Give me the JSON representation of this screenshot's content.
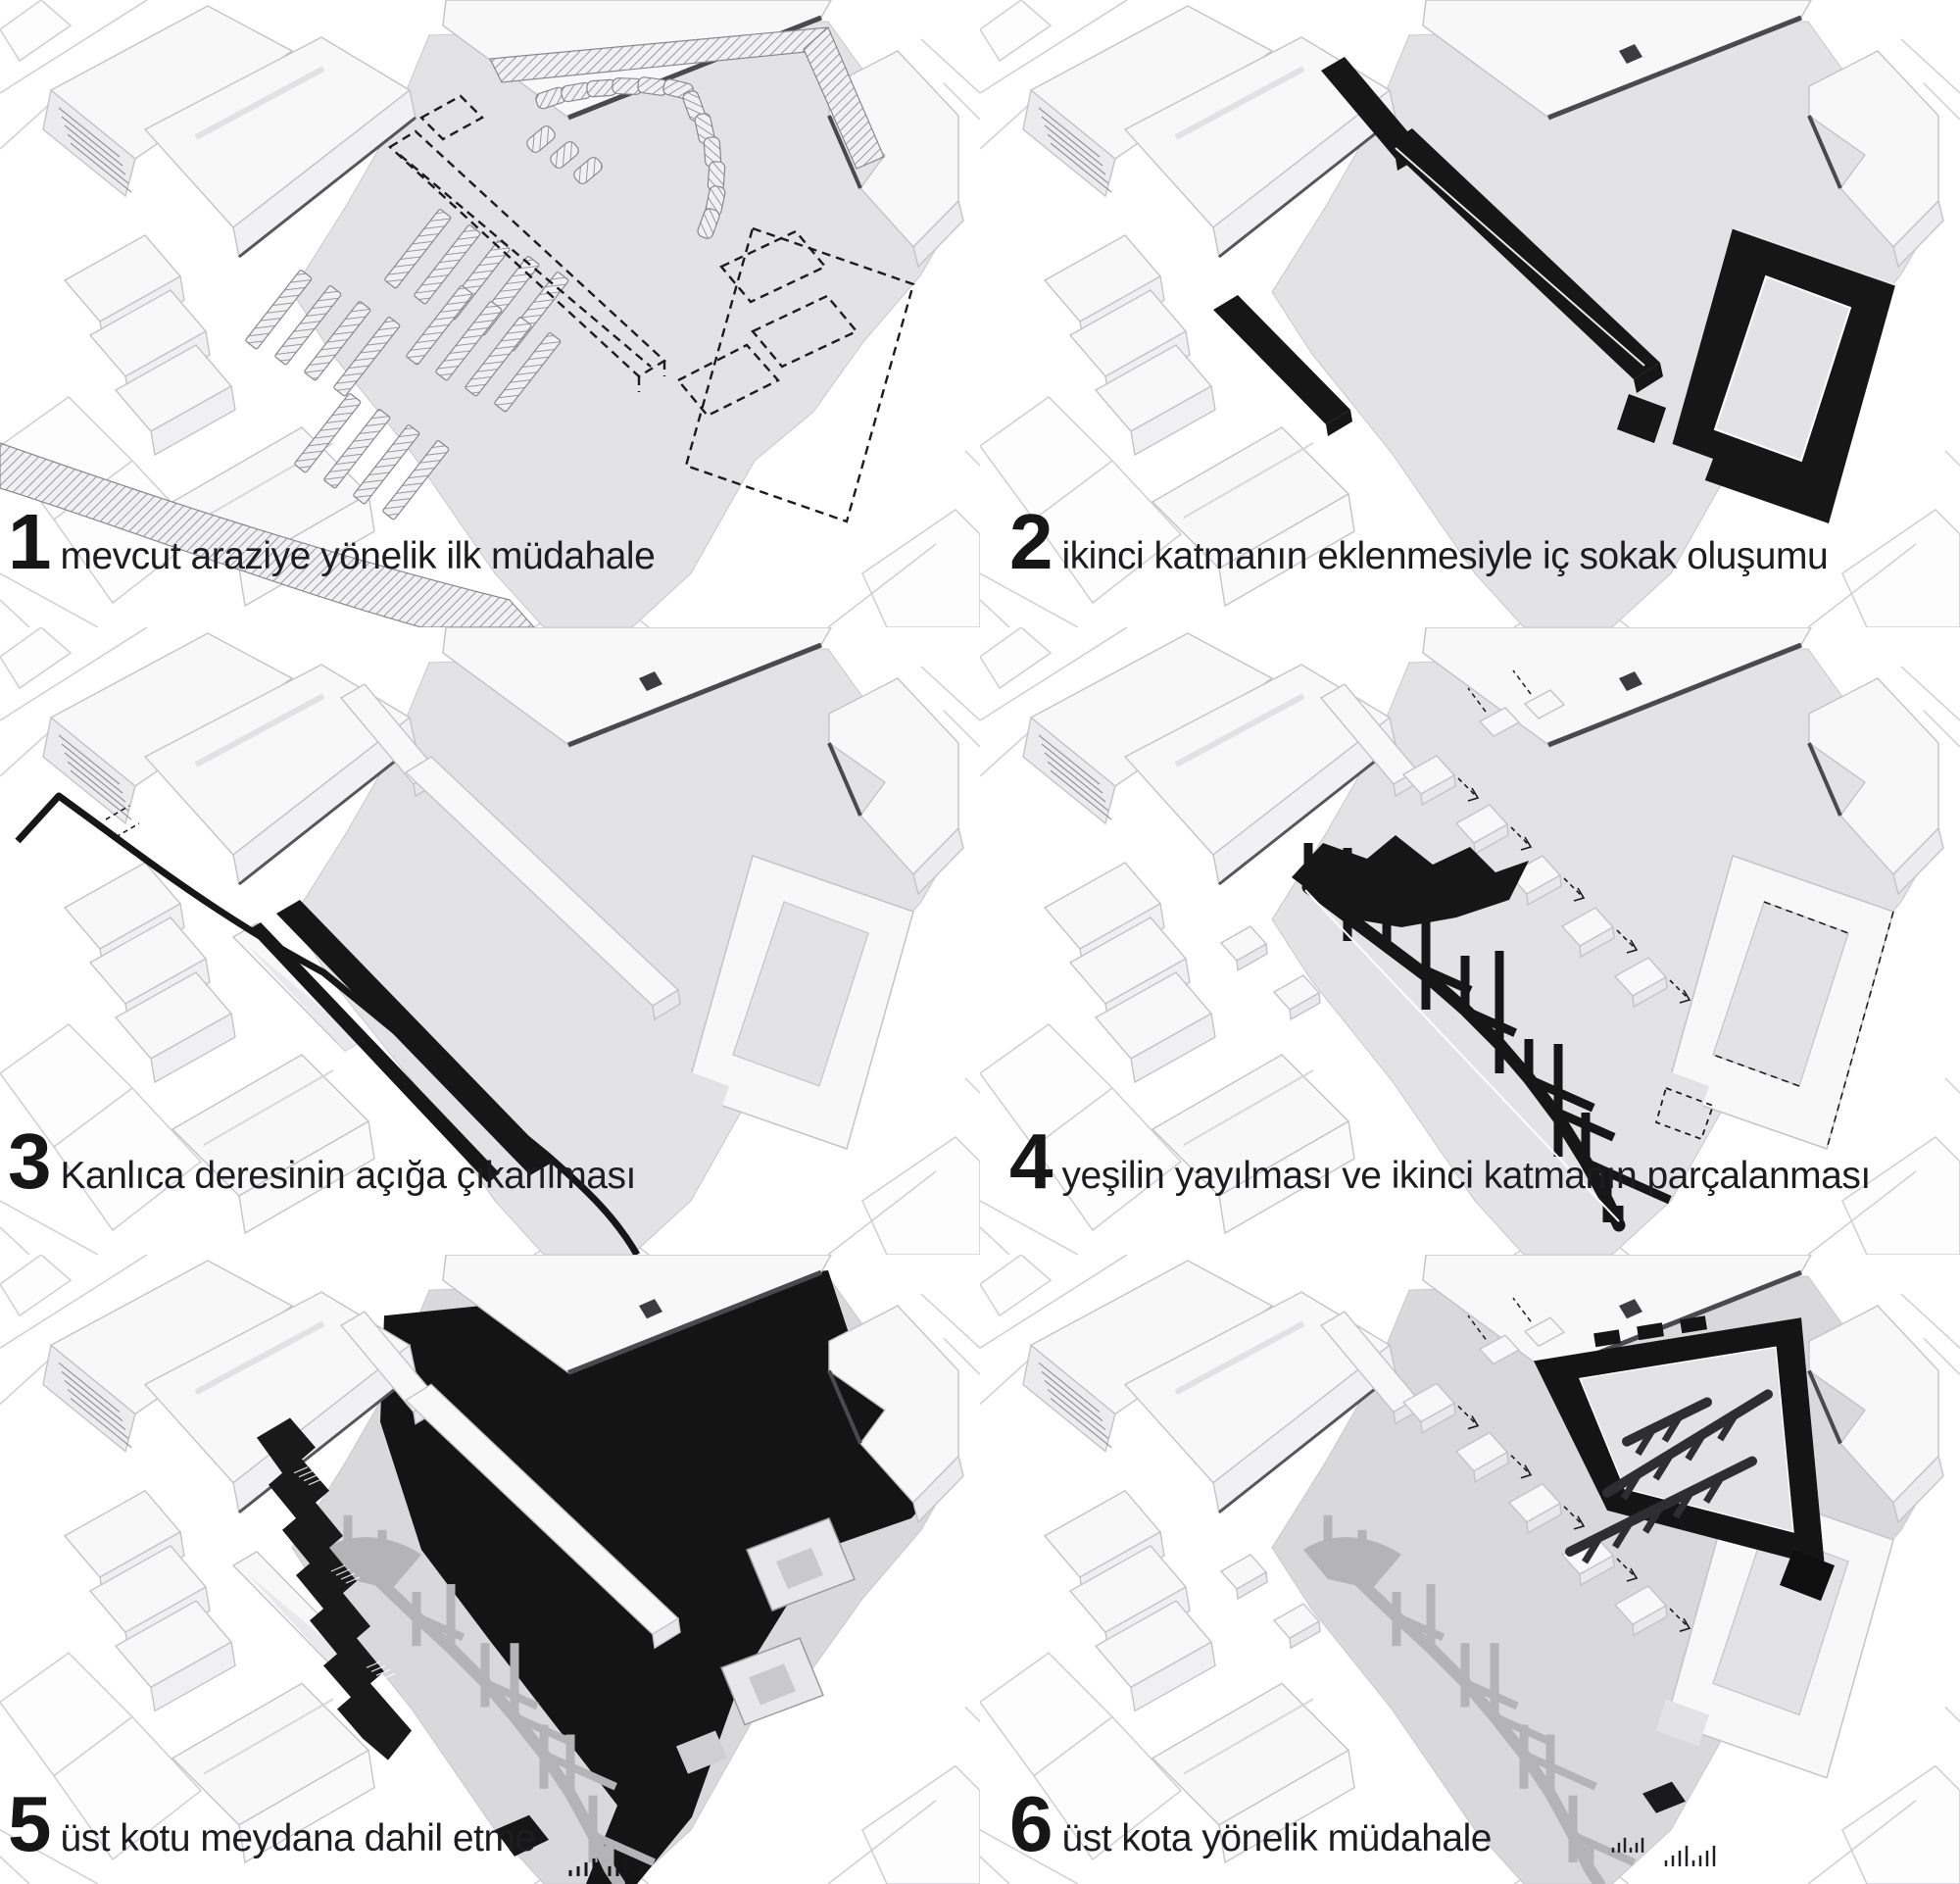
{
  "figure": {
    "type": "architectural-process-diagram",
    "language": "Turkish",
    "steps": [
      {
        "number": "1",
        "label": "mevcut araziye yönelik ilk müdahale",
        "elements": [
          "hatched-existing-parking-bars",
          "hatched-road-band",
          "dashed-proposed-volumes",
          "triangular-market-plaza"
        ]
      },
      {
        "number": "2",
        "label": "ikinci katmanın eklenmesiyle iç sokak oluşumu",
        "elements": [
          "black-second-layer-bars",
          "black-courtyard-ring",
          "inner-street"
        ]
      },
      {
        "number": "3",
        "label": "Kanlıca deresinin açığa çıkarılması",
        "elements": [
          "black-stream-line",
          "black-linear-bars",
          "white-second-layer"
        ]
      },
      {
        "number": "4",
        "label": "yeşilin yayılması ve ikinci katmanın parçalanması",
        "elements": [
          "black-green-spread-branches",
          "fragmented-white-boxes",
          "dashed-shift-arrows"
        ]
      },
      {
        "number": "5",
        "label": "üst kotu meydana dahil etme",
        "elements": [
          "black-upper-plaza",
          "terraced-stairs-band",
          "gray-path-network",
          "courtyard-openings"
        ]
      },
      {
        "number": "6",
        "label": "üst kota yönelik müdahale",
        "elements": [
          "black-triangular-ring",
          "branching-arms",
          "gray-path-network",
          "small-stairs"
        ]
      }
    ]
  },
  "colors": {
    "background": "#ffffff",
    "plaza": "#e3e3e5",
    "plaza_dark": "#d9d9db",
    "building": "#f8f8f9",
    "building_side": "#ececee",
    "outline": "#c4c4c8",
    "dark_edge": "#4a4a4e",
    "black": "#161616",
    "dash": "#1c1c1e",
    "hatch_stroke": "#8a8a8e",
    "comb_gray": "#b4b4b7",
    "context_line": "#cfcfd2",
    "text": "#1d1d1f"
  }
}
